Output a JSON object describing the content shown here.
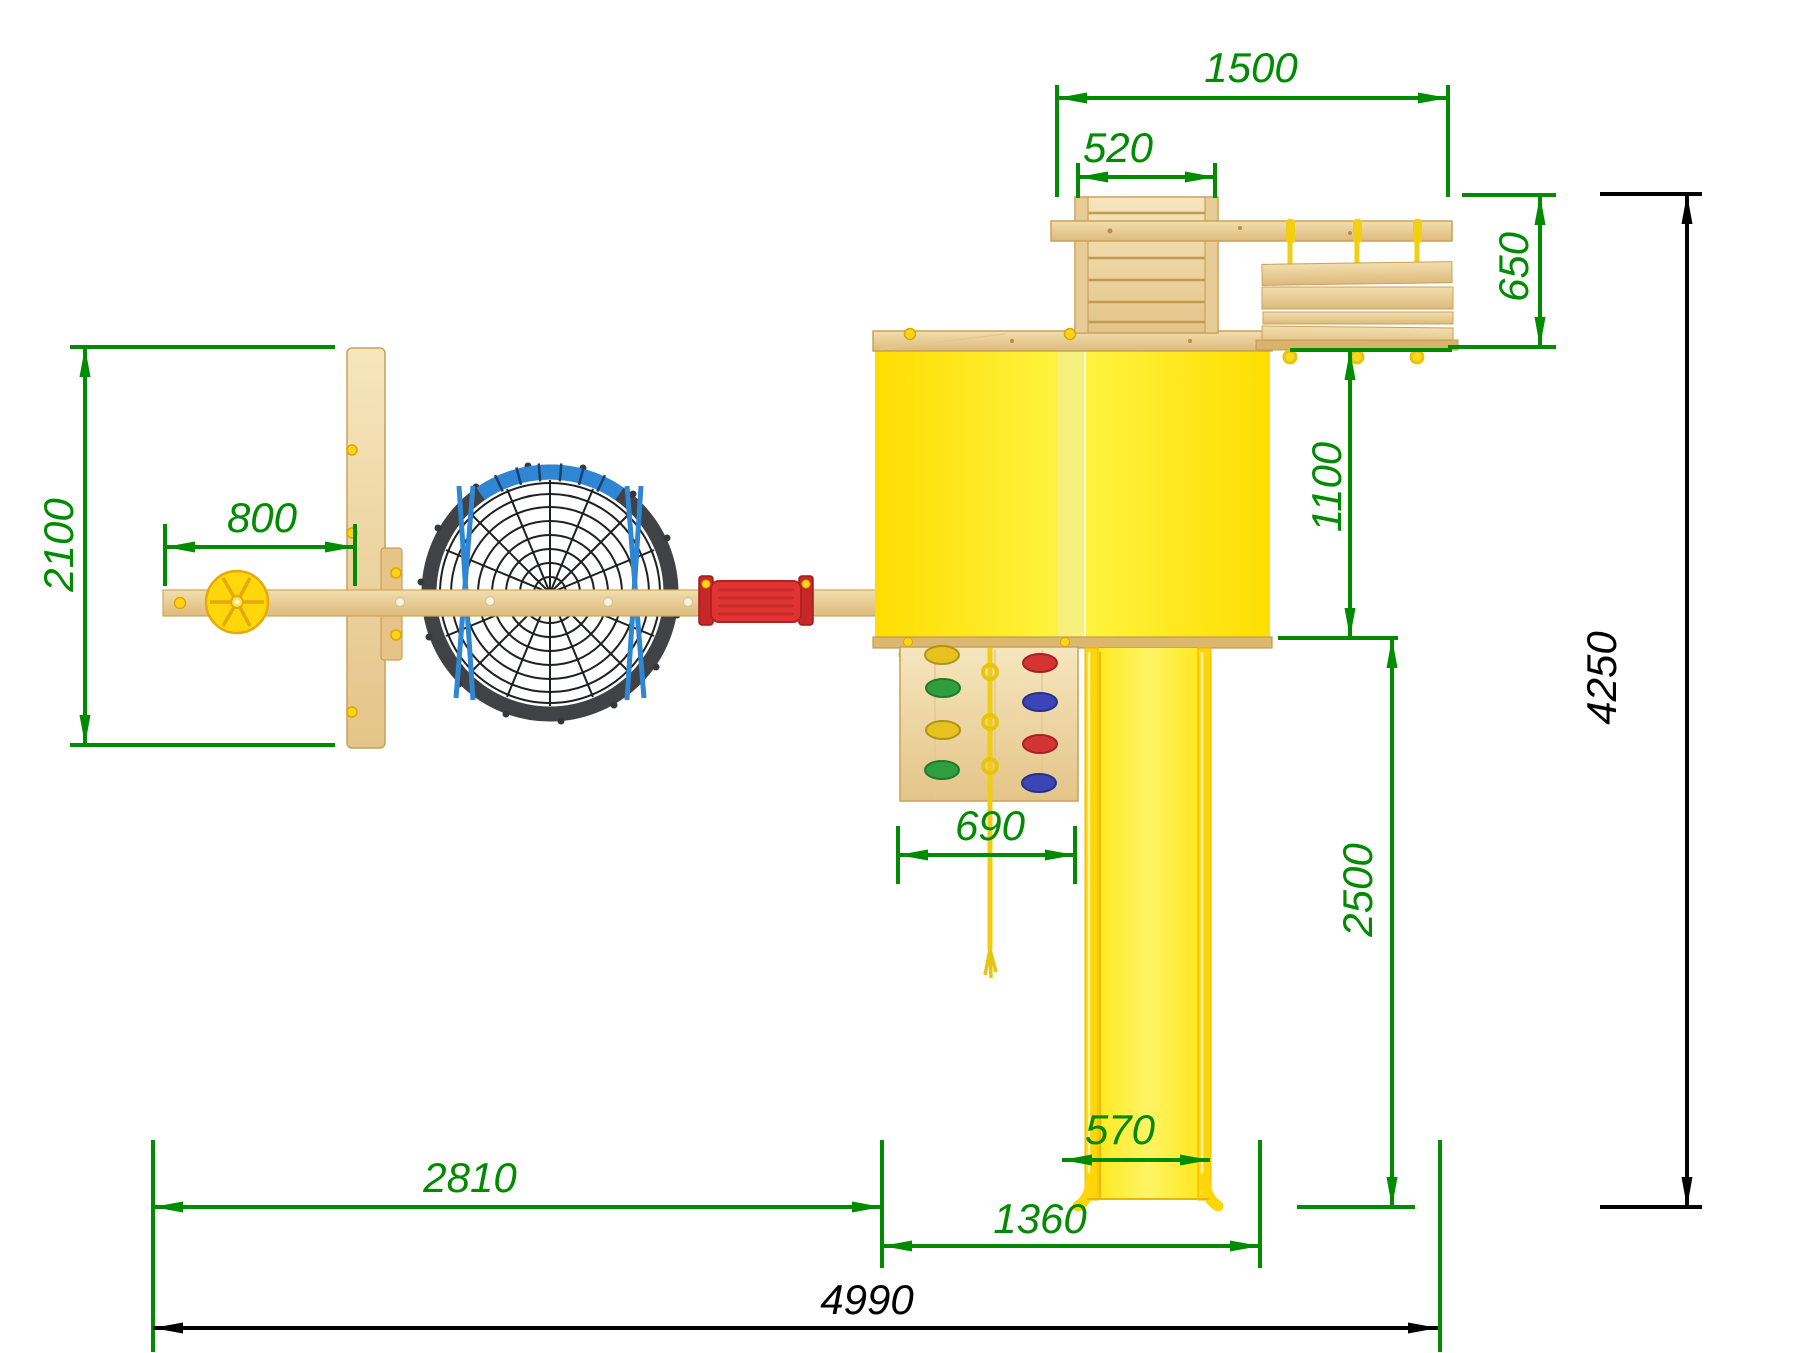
{
  "drawing": {
    "type": "playground-top-view-technical-drawing",
    "dimension_color": "#008b00",
    "overall_dimension_color": "#000000",
    "dimensions": {
      "d1500": "1500",
      "d520": "520",
      "d650": "650",
      "d1100": "1100",
      "d2500": "2500",
      "d4250": "4250",
      "d2100": "2100",
      "d800": "800",
      "d690": "690",
      "d570": "570",
      "d1360": "1360",
      "d2810": "2810",
      "d4990": "4990"
    }
  }
}
